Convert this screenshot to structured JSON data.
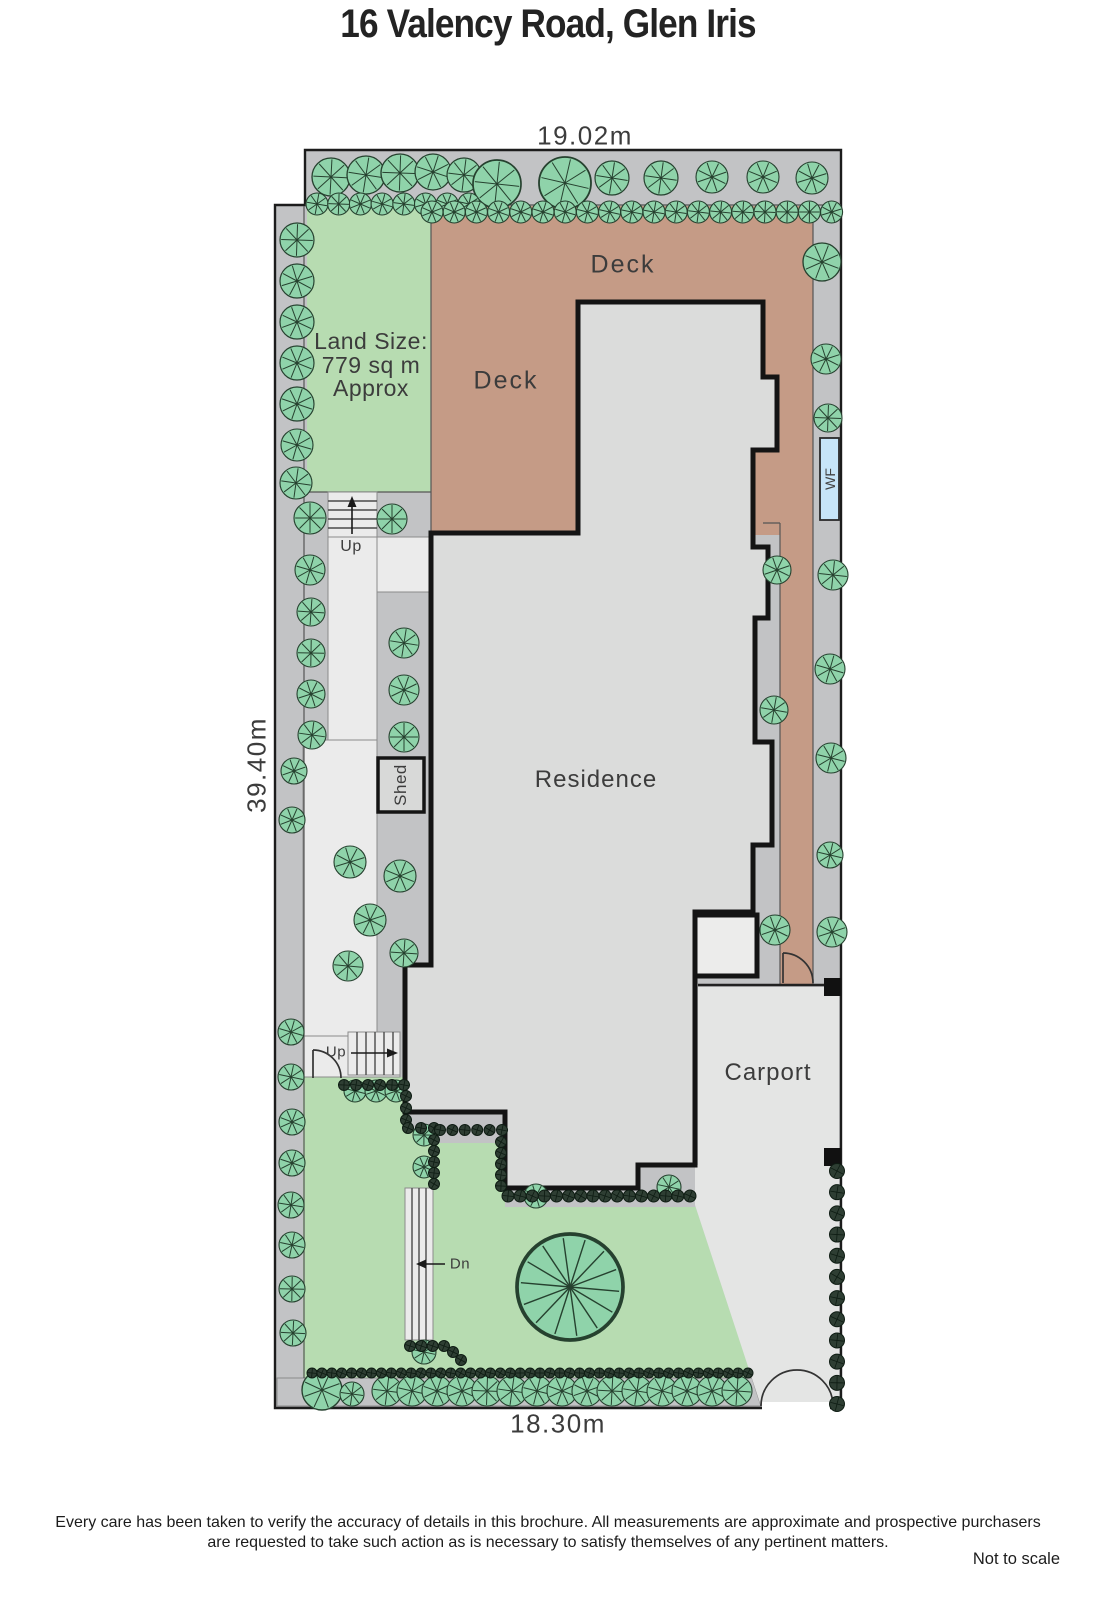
{
  "title": "16 Valency Road, Glen Iris",
  "plan": {
    "dimensions": {
      "top": "19.02m",
      "side": "39.40m",
      "bottom": "18.30m"
    },
    "labels": {
      "deck_upper": "Deck",
      "deck_lower": "Deck",
      "residence": "Residence",
      "carport": "Carport",
      "shed": "Shed",
      "water_feature": "WF",
      "stairs_up_top": "Up",
      "stairs_up_bottom": "Up",
      "stairs_down": "Dn"
    },
    "land_size": {
      "line1": "Land Size:",
      "line2": "779 sq m",
      "line3": "Approx"
    }
  },
  "footer": {
    "disclaimer_line1": "Every care has been taken to verify the accuracy of details in this brochure.  All measurements are approximate and prospective purchasers",
    "disclaimer_line2": "are requested to take such action as is necessary to satisfy themselves of any pertinent matters.",
    "scale_note": "Not to scale"
  },
  "colors": {
    "lawn": "#b7dcb1",
    "deck": "#c59b86",
    "residence": "#dbdcdb",
    "boundary_strip": "#c2c3c5",
    "path": "#ebebeb",
    "carport": "#e4e5e4",
    "tree": "#8fd3aa",
    "shrub": "#2e3e33",
    "water": "#c7e5f8",
    "wall": "#141414"
  },
  "icons": {
    "tree": "tree-icon",
    "shrub": "shrub-icon",
    "gate": "gate-arc-icon",
    "stairs": "stairs-icon"
  }
}
